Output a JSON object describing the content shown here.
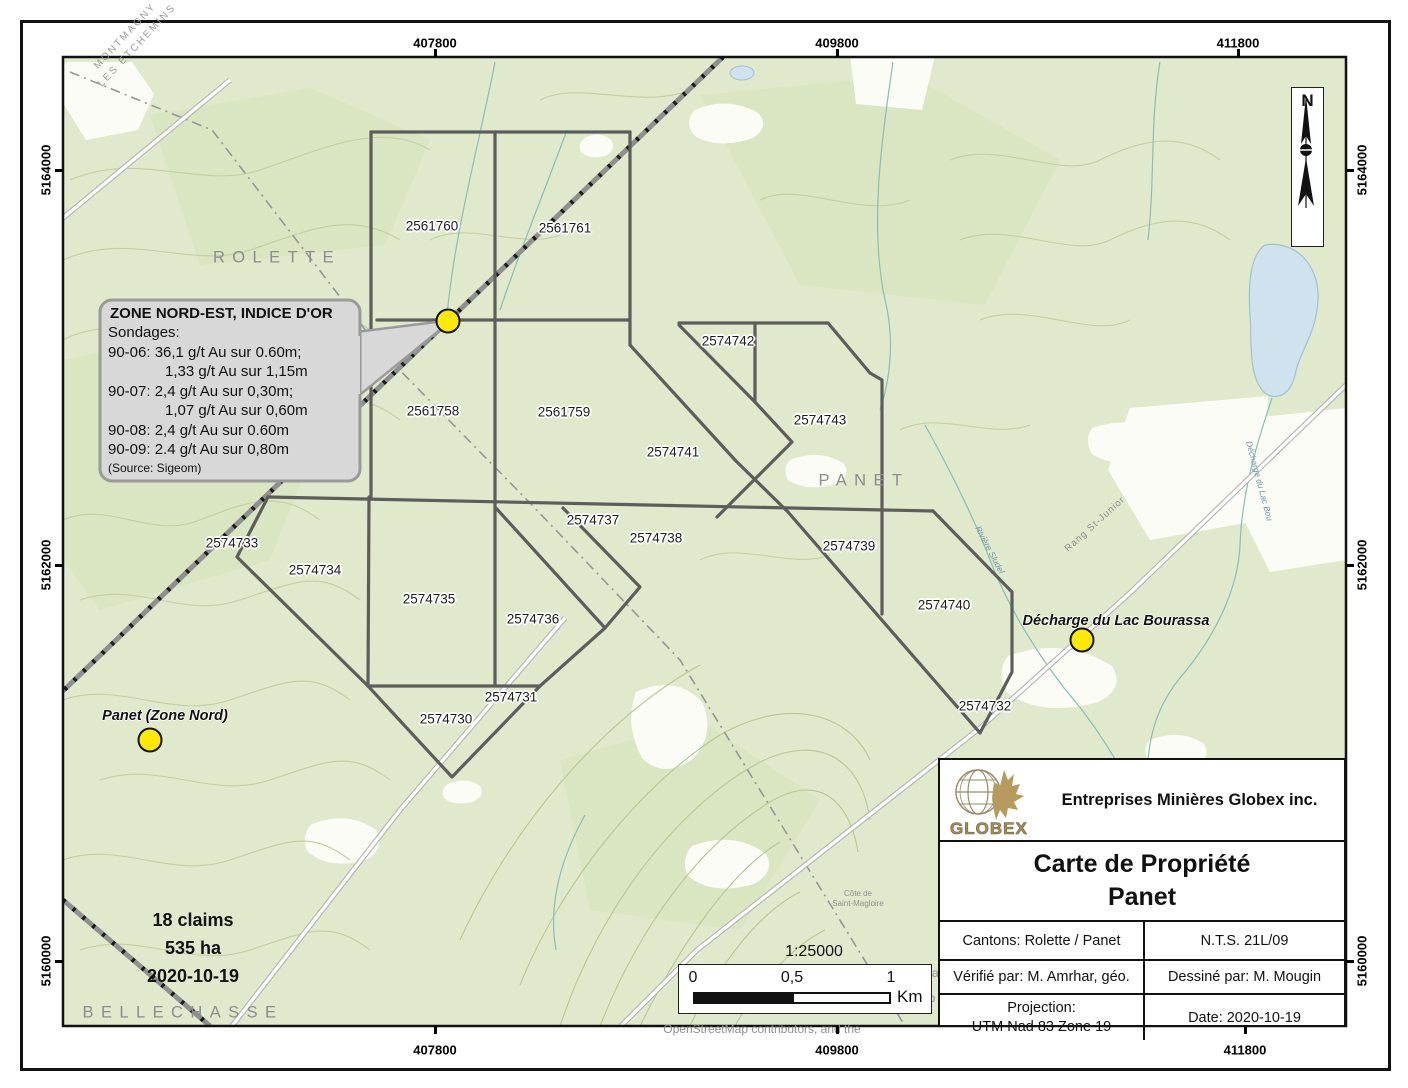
{
  "map": {
    "colors": {
      "land": "#e0e9cc",
      "forest": "#d4e0b6",
      "white_patch": "#fbfcf6",
      "water_fill": "#cfe2ee",
      "water_line": "#9ec2d2",
      "stream": "#8abdb6",
      "contour": "#c3cfa0",
      "claim_line": "#5d5d5d",
      "marker_yellow": "#ffe900",
      "gold": "#ab9258",
      "callout_fill": "#d8d8d8",
      "callout_border": "#9a9a9a"
    },
    "claims": [
      {
        "id": "2561760",
        "x": 432,
        "y": 226
      },
      {
        "id": "2561761",
        "x": 565,
        "y": 228
      },
      {
        "id": "2561758",
        "x": 433,
        "y": 411
      },
      {
        "id": "2561759",
        "x": 564,
        "y": 412
      },
      {
        "id": "2574742",
        "x": 728,
        "y": 341
      },
      {
        "id": "2574743",
        "x": 820,
        "y": 420
      },
      {
        "id": "2574741",
        "x": 673,
        "y": 452
      },
      {
        "id": "2574737",
        "x": 593,
        "y": 520
      },
      {
        "id": "2574738",
        "x": 656,
        "y": 538
      },
      {
        "id": "2574739",
        "x": 849,
        "y": 546
      },
      {
        "id": "2574733",
        "x": 232,
        "y": 543
      },
      {
        "id": "2574734",
        "x": 315,
        "y": 570
      },
      {
        "id": "2574735",
        "x": 429,
        "y": 599
      },
      {
        "id": "2574736",
        "x": 533,
        "y": 619
      },
      {
        "id": "2574740",
        "x": 944,
        "y": 605
      },
      {
        "id": "2574731",
        "x": 511,
        "y": 697
      },
      {
        "id": "2574730",
        "x": 446,
        "y": 719
      },
      {
        "id": "2574732",
        "x": 985,
        "y": 706
      }
    ],
    "area_labels": [
      {
        "text": "ROLETTE",
        "x": 277,
        "y": 258
      },
      {
        "text": "PANET",
        "x": 864,
        "y": 481
      },
      {
        "text": "BELLECHASSE",
        "x": 183,
        "y": 1013
      }
    ],
    "boundary_label": {
      "line1": "MONTMAGNY",
      "line2": "LES ETCHEMINS"
    },
    "hill_label": {
      "line1": "Côte de",
      "line2": "Saint-Magloire"
    },
    "road_label": "Rang St-Junior",
    "stream_labels": [
      {
        "text": "Rivière Sludel"
      },
      {
        "text": "Décharge du Lac Bou"
      }
    ],
    "poi": [
      {
        "label": "Panet (Zone Nord)",
        "lx": 165,
        "ly": 716,
        "cx": 150,
        "cy": 740
      },
      {
        "label": "Décharge du Lac Bourassa",
        "lx": 1116,
        "ly": 621,
        "cx": 1082,
        "cy": 640
      }
    ],
    "claim_marker": {
      "cx": 448,
      "cy": 321
    },
    "callout": {
      "title": "ZONE NORD-EST, INDICE D'OR",
      "lines": [
        {
          "text": "Sondages:",
          "indent": false
        },
        {
          "text": "90-06: 36,1 g/t Au sur 0.60m;",
          "indent": false
        },
        {
          "text": "1,33 g/t Au sur 1,15m",
          "indent": true
        },
        {
          "text": "90-07: 2,4 g/t Au sur 0,30m;",
          "indent": false
        },
        {
          "text": "1,07 g/t Au sur 0,60m",
          "indent": true
        },
        {
          "text": "90-08: 2,4 g/t Au sur 0.60m",
          "indent": false
        },
        {
          "text": "90-09: 2.4 g/t Au sur 0,80m",
          "indent": false
        }
      ],
      "source": "(Source: Sigeom)"
    },
    "summary": {
      "line1": "18 claims",
      "line2": "535 ha",
      "line3": "2020-10-19"
    },
    "coordinates": {
      "top": [
        {
          "t": "407800",
          "x": 435
        },
        {
          "t": "409800",
          "x": 837
        },
        {
          "t": "411800",
          "x": 1238
        }
      ],
      "bottom": [
        {
          "t": "407800",
          "x": 435
        },
        {
          "t": "409800",
          "x": 837
        },
        {
          "t": "411800",
          "x": 1245
        }
      ],
      "left": [
        {
          "t": "5164000",
          "y": 170
        },
        {
          "t": "5162000",
          "y": 565
        },
        {
          "t": "5160000",
          "y": 961
        }
      ],
      "right": [
        {
          "t": "5164000",
          "y": 170
        },
        {
          "t": "5162000",
          "y": 565
        },
        {
          "t": "5160000",
          "y": 961
        }
      ]
    },
    "north_label": "N",
    "scalebar": {
      "ratio": "1:25000",
      "t0": "0",
      "t05": "0,5",
      "t1": "1",
      "unit": "Km"
    },
    "attribution": {
      "frag1": "ma",
      "frag2": "no",
      "line": "OpenStreetMap contributors, and the"
    }
  },
  "titleblock": {
    "logo_text": "GLOBEX",
    "company": "Entreprises Minières Globex inc.",
    "title_line1": "Carte de Propriété",
    "title_line2": "Panet",
    "cantons": "Cantons: Rolette / Panet",
    "nts": "N.T.S. 21L/09",
    "verified": "Vérifié par: M. Amrhar, géo.",
    "drawn": "Dessiné par: M. Mougin",
    "projection_label": "Projection:",
    "projection_value": "UTM Nad 83 Zone 19",
    "date": "Date: 2020-10-19"
  }
}
